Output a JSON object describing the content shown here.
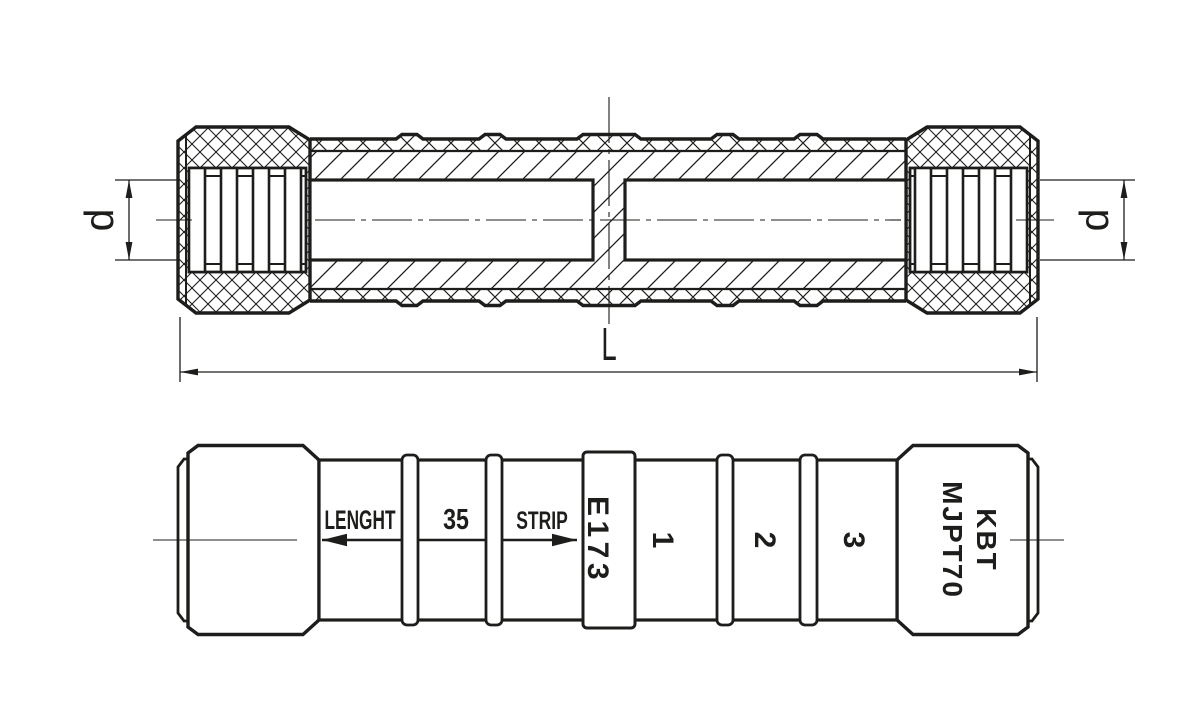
{
  "drawing": {
    "title": "MJPT splice connector technical drawing",
    "background_color": "#ffffff",
    "line_color": "#1d1d1b",
    "section_view": {
      "diameter_label_left": "d",
      "diameter_label_right": "d",
      "length_label": "L"
    },
    "side_view": {
      "strip_arrow_label": "LENGHT",
      "strip_length_value": "35",
      "strip_label": "STRIP",
      "die_code": "E173",
      "crimp_mark_1": "1",
      "crimp_mark_2": "2",
      "crimp_mark_3": "3",
      "brand": "KBT",
      "model": "MJPT70"
    }
  }
}
